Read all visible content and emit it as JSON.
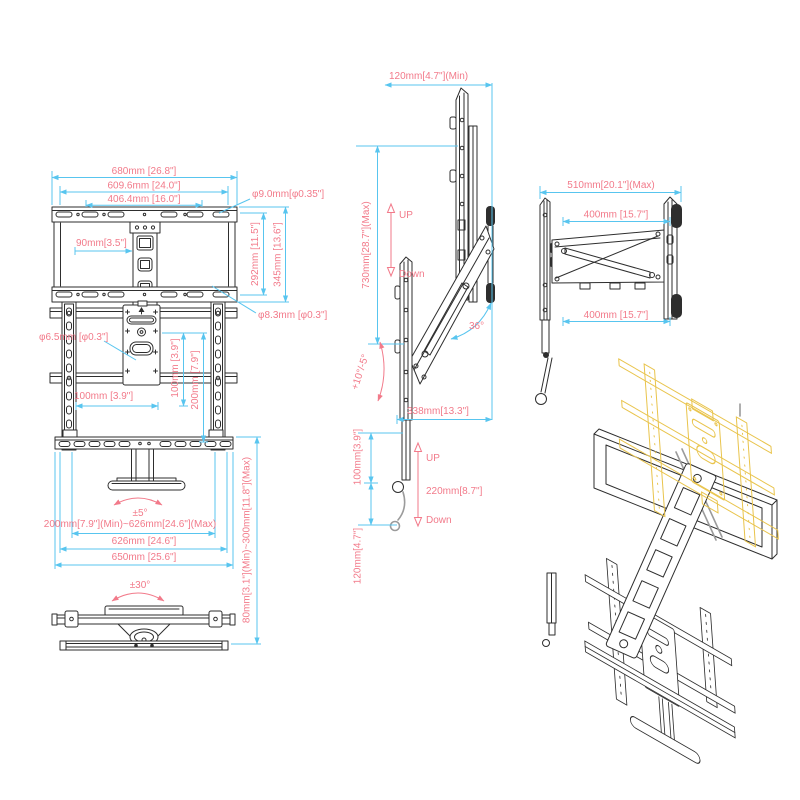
{
  "colors": {
    "dimension_line": "#58c5ef",
    "label_text": "#f27a8a",
    "line_art": "#2e2e2e",
    "highlight_part": "#e9c44c",
    "background": "#ffffff"
  },
  "front_view": {
    "width_overall": "680mm [26.8\"]",
    "width_outer_holes": "609.6mm [24.0\"]",
    "width_inner_holes": "406.4mm [16.0\"]",
    "hole_top": "φ9.0mm[φ0.35\"]",
    "column_width": "90mm[3.5\"]",
    "height_holes": "292mm [11.5\"]",
    "height_overall": "345mm [13.6\"]",
    "hole_mid": "φ8.3mm [φ0.3\"]",
    "hole_plate": "φ6.5mm [φ0.3\"]",
    "plate_width": "100mm [3.9\"]",
    "plate_height_100": "100mm [3.9\"]",
    "plate_height_200": "200mm [7.9\"]",
    "swivel_fine": "±5°",
    "width_range": "200mm[7.9\"](Min)~626mm[24.6\"](Max)",
    "width_shelf_inner": "626mm [24.6\"]",
    "width_shelf_outer": "650mm [25.6\"]",
    "height_range": "80mm[3.1\"](Min)~300mm[11.8\"](Max)"
  },
  "top_view": {
    "swivel_range": "±30°"
  },
  "side_view": {
    "depth_min": "120mm[4.7\"](Min)",
    "lift_max": "730mm[28.7\"](Max)",
    "up_label_1": "UP",
    "down_label_1": "Down",
    "arm_angle": "36°",
    "tilt_range": "+10°/-5°",
    "arm_length": "338mm[13.3\"]",
    "lower_offset_100": "100mm[3.9\"]",
    "up_label_2": "UP",
    "travel_220": "220mm[8.7\"]",
    "down_label_2": "Down",
    "lower_offset_120": "120mm[4.7\"]"
  },
  "extended_view": {
    "extension_max": "510mm[20.1\"](Max)",
    "arm_top": "400mm [15.7\"]",
    "arm_bottom": "400mm [15.7\"]"
  }
}
